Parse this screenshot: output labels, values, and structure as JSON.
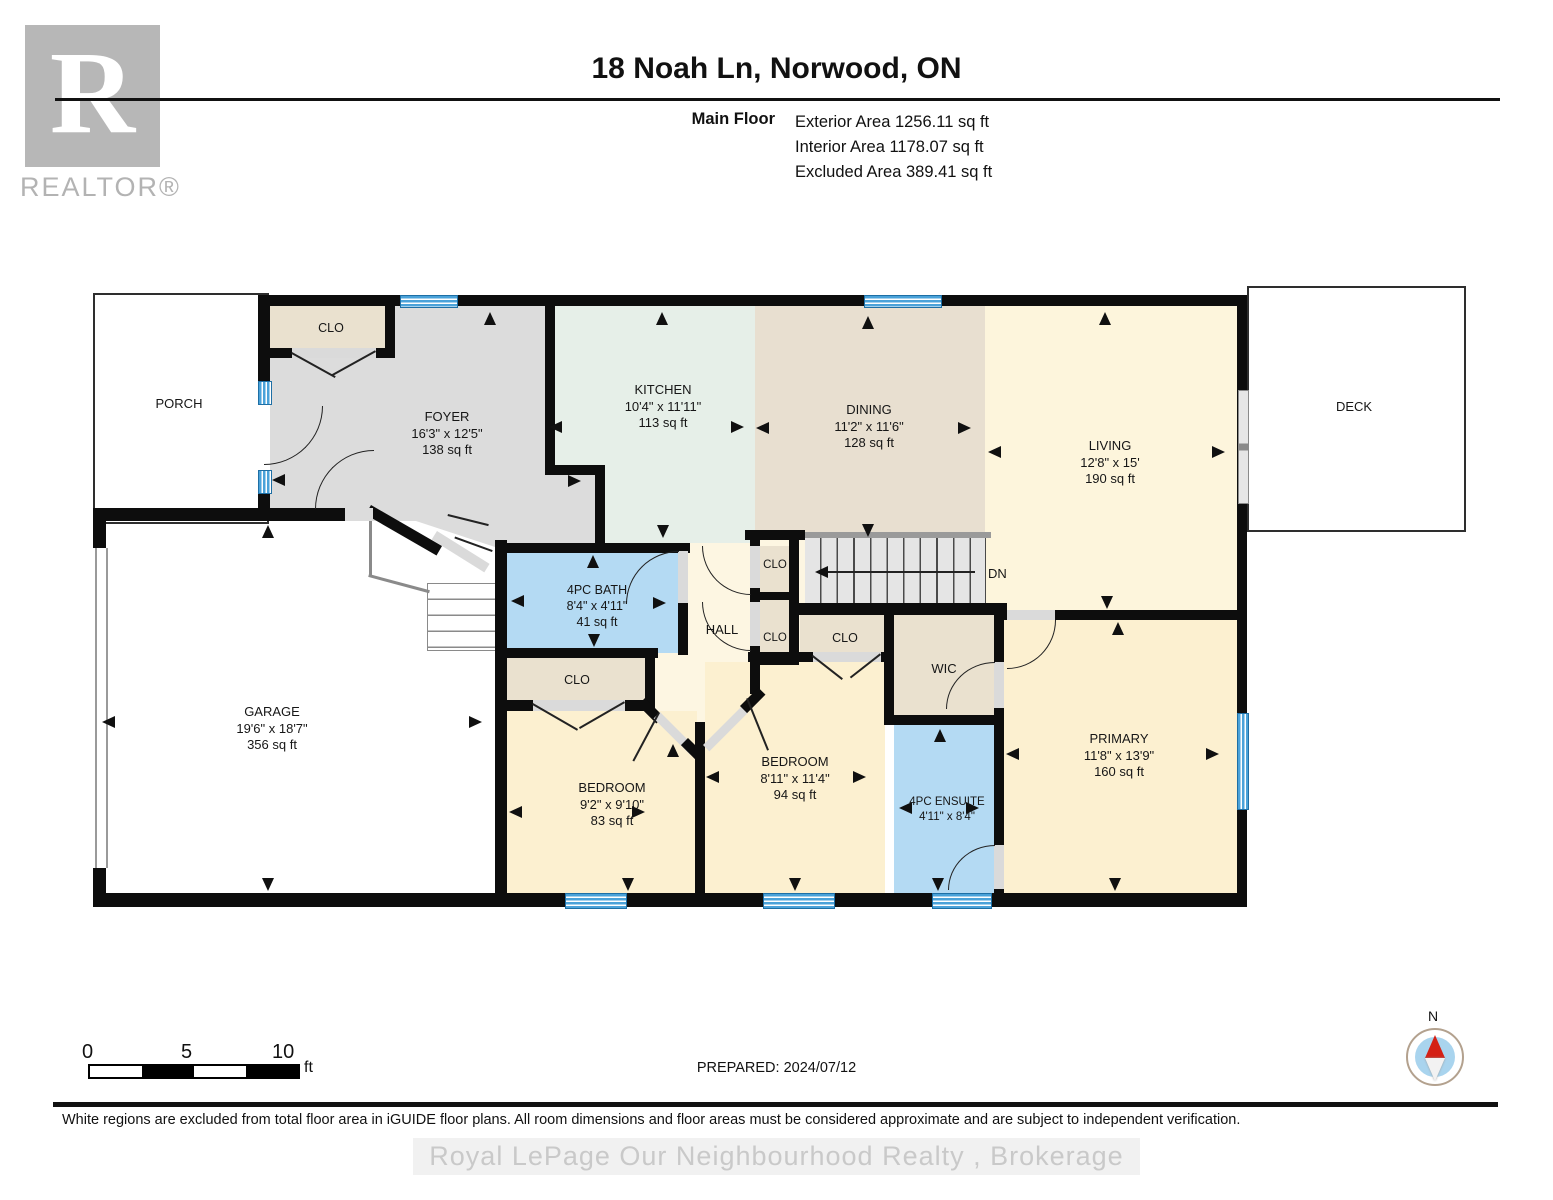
{
  "header": {
    "title": "18 Noah Ln, Norwood, ON",
    "floor_label": "Main Floor",
    "exterior_area": "Exterior Area 1256.11 sq ft",
    "interior_area": "Interior Area 1178.07 sq ft",
    "excluded_area": "Excluded Area 389.41 sq ft"
  },
  "branding": {
    "logo_letter": "R",
    "logo_text": "REALTOR®"
  },
  "rooms": {
    "porch": {
      "name": "PORCH"
    },
    "deck": {
      "name": "DECK"
    },
    "foyer": {
      "name": "FOYER",
      "dims": "16'3\" x 12'5\"",
      "area": "138 sq ft"
    },
    "kitchen": {
      "name": "KITCHEN",
      "dims": "10'4\" x 11'11\"",
      "area": "113 sq ft"
    },
    "dining": {
      "name": "DINING",
      "dims": "11'2\" x 11'6\"",
      "area": "128 sq ft"
    },
    "living": {
      "name": "LIVING",
      "dims": "12'8\" x 15'",
      "area": "190 sq ft"
    },
    "garage": {
      "name": "GARAGE",
      "dims": "19'6\" x 18'7\"",
      "area": "356 sq ft"
    },
    "bath": {
      "name": "4PC BATH",
      "dims": "8'4\" x 4'11\"",
      "area": "41 sq ft"
    },
    "hall": {
      "name": "HALL"
    },
    "wic": {
      "name": "WIC"
    },
    "bedroom1": {
      "name": "BEDROOM",
      "dims": "9'2\" x 9'10\"",
      "area": "83 sq ft"
    },
    "bedroom2": {
      "name": "BEDROOM",
      "dims": "8'11\" x 11'4\"",
      "area": "94 sq ft"
    },
    "ensuite": {
      "name": "4PC ENSUITE",
      "dims": "4'11\" x 8'4\""
    },
    "primary": {
      "name": "PRIMARY",
      "dims": "11'8\" x 13'9\"",
      "area": "160 sq ft"
    },
    "closet_foyer": {
      "name": "CLO"
    },
    "closet_hall_upper": {
      "name": "CLO"
    },
    "closet_hall_lower": {
      "name": "CLO"
    },
    "closet_bath": {
      "name": "CLO"
    },
    "closet_bedroom2": {
      "name": "CLO"
    },
    "stairs_label": "DN"
  },
  "scale_bar": {
    "tick0": "0",
    "tick1": "5",
    "tick2": "10",
    "unit": "ft"
  },
  "prepared_label": "PREPARED: 2024/07/12",
  "compass": {
    "north_label": "N"
  },
  "footer": {
    "disclaimer": "White regions are excluded from total floor area in iGUIDE floor plans. All room dimensions and floor areas must be considered approximate and are subject to independent verification.",
    "watermark": "Royal LePage Our Neighbourhood Realty , Brokerage"
  },
  "colors": {
    "wall": "#0d0d0d",
    "window": "#4aa2d9",
    "window_border": "#1e6fa5",
    "foyer": "#dcdcdc",
    "kitchen": "#e6efe8",
    "dining": "#e8dfd0",
    "living": "#fdf5dc",
    "hall": "#fdf6e2",
    "bedroom": "#fcf0d0",
    "closet": "#eae1cf",
    "bath": "#b4daf3",
    "stairs": "#e5e5e5",
    "compass_red": "#d42015",
    "compass_blue": "#a9d4ee",
    "watermark": "#c9c9c9"
  }
}
